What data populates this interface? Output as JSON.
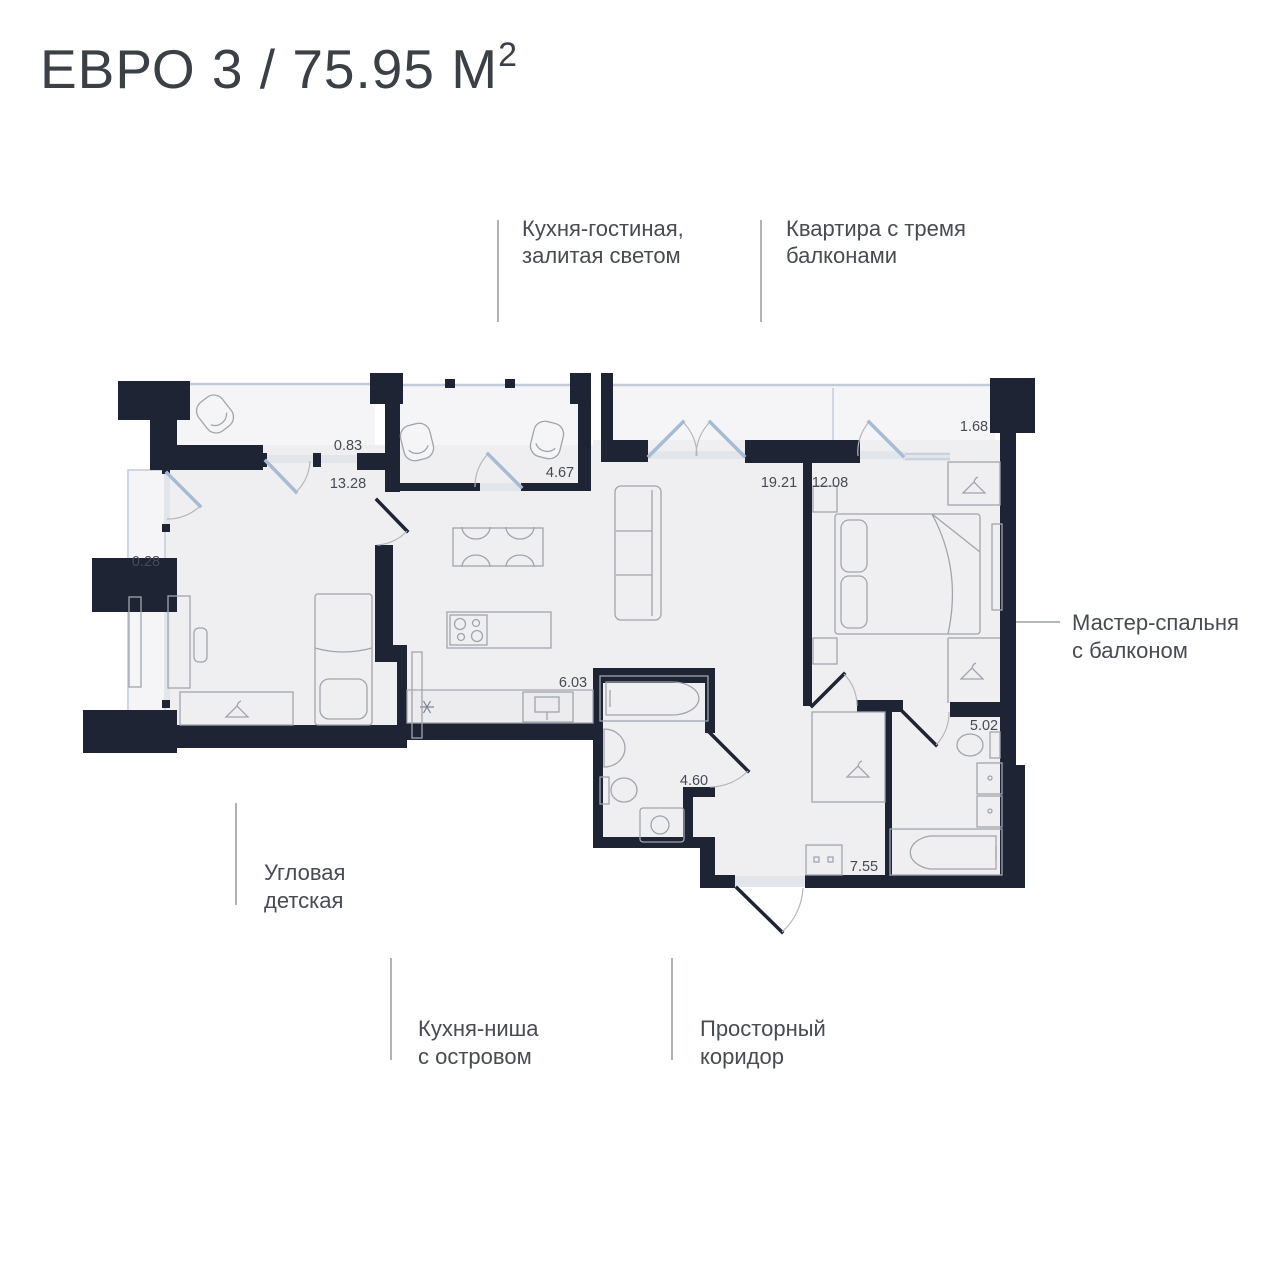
{
  "title": {
    "main": "ЕВРО 3 / 75.95 М",
    "sup": "2"
  },
  "callouts": {
    "kitchen_living": {
      "line1": "Кухня-гостиная,",
      "line2": "залитая светом"
    },
    "three_balconies": {
      "line1": "Квартира с тремя",
      "line2": "балконами"
    },
    "master_bedroom": {
      "line1": "Мастер-спальня",
      "line2": "с балконом"
    },
    "corner_children": {
      "line1": "Угловая",
      "line2": "детская"
    },
    "kitchen_niche": {
      "line1": "Кухня-ниша",
      "line2": "с островом"
    },
    "corridor": {
      "line1": "Просторный",
      "line2": "коридор"
    }
  },
  "areas": {
    "balcony_topleft": "0.83",
    "children_room": "13.28",
    "balcony_middle": "4.67",
    "kitchen_living": "19.21",
    "master_bedroom": "12.08",
    "balcony_right": "1.68",
    "balcony_left": "0.28",
    "kitchen_niche": "6.03",
    "bathroom": "4.60",
    "master_bathroom": "5.02",
    "corridor": "7.55"
  },
  "icons": {
    "hanger": "hanger-icon",
    "cooktop": "cooktop-icon",
    "sink_star": "extract-fan-icon"
  },
  "colors": {
    "wall": "#1e2433",
    "room_fill": "#efeff1",
    "balcony_fill": "#f5f5f7",
    "furniture_stroke": "#a0a5ad",
    "window_blue": "#a7bcd4",
    "text_dark": "#3b4047",
    "label_gray": "#454a54",
    "callout_line": "#9aa0a8",
    "background": "#ffffff"
  }
}
